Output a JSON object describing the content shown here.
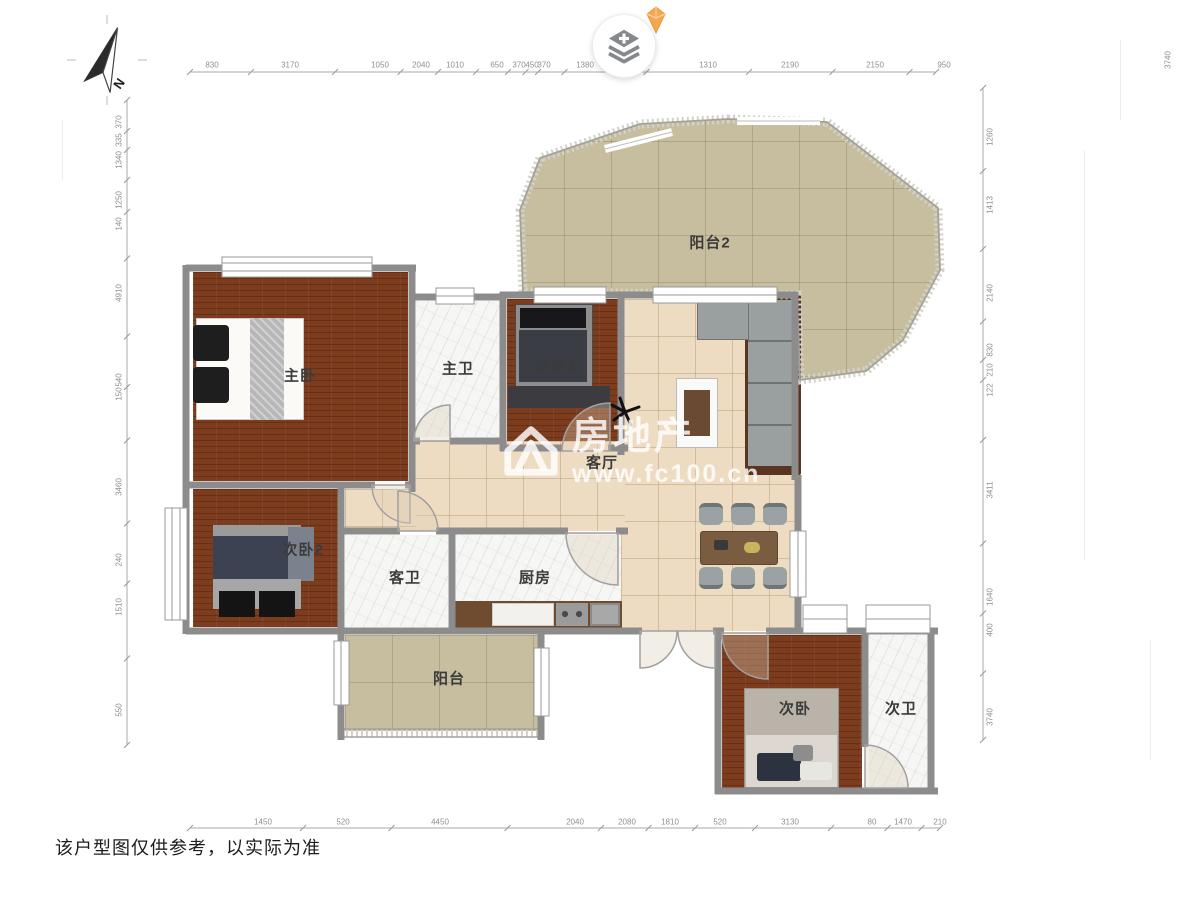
{
  "canvas": {
    "disclaimer": "该户型图仅供参考，以实际为准"
  },
  "compass": {
    "label": "N"
  },
  "toolbar": {
    "button_icon": "layers-add-icon",
    "badge_icon": "vip-gem-icon"
  },
  "watermark": {
    "brand": "房地产",
    "url": "www.fc100.cn",
    "logo_icon": "house-logo-icon"
  },
  "colors": {
    "wood": "#7d3c1e",
    "tile": "#eedcc2",
    "balcony": "#c7be9f",
    "marble": "#f6f6f4",
    "wall": "#8c8c8c",
    "gem": "#f3a74f"
  },
  "rooms": [
    {
      "id": "balcony2",
      "label": "阳台2",
      "x": 710,
      "y": 242
    },
    {
      "id": "master-bedroom",
      "label": "主卧",
      "x": 300,
      "y": 375
    },
    {
      "id": "master-bath",
      "label": "主卫",
      "x": 458,
      "y": 368
    },
    {
      "id": "bedroom3",
      "label": "次卧3",
      "x": 556,
      "y": 366
    },
    {
      "id": "living-room",
      "label": "客厅",
      "x": 602,
      "y": 462
    },
    {
      "id": "bedroom2",
      "label": "次卧2",
      "x": 303,
      "y": 549
    },
    {
      "id": "guest-bath",
      "label": "客卫",
      "x": 405,
      "y": 577
    },
    {
      "id": "kitchen",
      "label": "厨房",
      "x": 535,
      "y": 577
    },
    {
      "id": "balcony",
      "label": "阳台",
      "x": 449,
      "y": 678
    },
    {
      "id": "bedroom",
      "label": "次卧",
      "x": 795,
      "y": 708
    },
    {
      "id": "bath2",
      "label": "次卫",
      "x": 901,
      "y": 708
    }
  ],
  "rulers": {
    "top": {
      "vertical": false,
      "line": 72,
      "axis": 65,
      "start": 190,
      "end": 936,
      "labels": [
        {
          "v": "830",
          "pos": 212
        },
        {
          "v": "3170",
          "pos": 290
        },
        {
          "v": "1050",
          "pos": 380
        },
        {
          "v": "2040",
          "pos": 421
        },
        {
          "v": "1010",
          "pos": 455
        },
        {
          "v": "650",
          "pos": 497
        },
        {
          "v": "370",
          "pos": 519
        },
        {
          "v": "450",
          "pos": 532
        },
        {
          "v": "370",
          "pos": 544
        },
        {
          "v": "1380",
          "pos": 585
        },
        {
          "v": "1310",
          "pos": 708
        },
        {
          "v": "2190",
          "pos": 790
        },
        {
          "v": "2150",
          "pos": 875
        },
        {
          "v": "950",
          "pos": 944
        }
      ]
    },
    "bottom": {
      "vertical": false,
      "line": 828,
      "axis": 822,
      "start": 190,
      "end": 940,
      "labels": [
        {
          "v": "1450",
          "pos": 263
        },
        {
          "v": "520",
          "pos": 343
        },
        {
          "v": "4450",
          "pos": 440
        },
        {
          "v": "2040",
          "pos": 575
        },
        {
          "v": "2080",
          "pos": 627
        },
        {
          "v": "1810",
          "pos": 670
        },
        {
          "v": "520",
          "pos": 720
        },
        {
          "v": "3130",
          "pos": 790
        },
        {
          "v": "80",
          "pos": 872
        },
        {
          "v": "1470",
          "pos": 903
        },
        {
          "v": "210",
          "pos": 940
        }
      ]
    },
    "left": {
      "vertical": true,
      "line": 127,
      "axis": 119,
      "start": 100,
      "end": 745,
      "labels": [
        {
          "v": "370",
          "pos": 122
        },
        {
          "v": "335",
          "pos": 140
        },
        {
          "v": "1340",
          "pos": 160
        },
        {
          "v": "1250",
          "pos": 200
        },
        {
          "v": "140",
          "pos": 224
        },
        {
          "v": "4910",
          "pos": 293
        },
        {
          "v": "540",
          "pos": 380
        },
        {
          "v": "150",
          "pos": 394
        },
        {
          "v": "3460",
          "pos": 487
        },
        {
          "v": "240",
          "pos": 560
        },
        {
          "v": "1510",
          "pos": 607
        },
        {
          "v": "550",
          "pos": 710
        }
      ]
    },
    "right": {
      "vertical": true,
      "line": 983,
      "axis": 990,
      "start": 88,
      "end": 740,
      "labels": [
        {
          "v": "1260",
          "pos": 137
        },
        {
          "v": "1413",
          "pos": 205
        },
        {
          "v": "2140",
          "pos": 293
        },
        {
          "v": "830",
          "pos": 350
        },
        {
          "v": "210",
          "pos": 370
        },
        {
          "v": "122",
          "pos": 390
        },
        {
          "v": "3411",
          "pos": 490
        },
        {
          "v": "1640",
          "pos": 597
        },
        {
          "v": "400",
          "pos": 630
        },
        {
          "v": "3740",
          "pos": 717
        }
      ]
    },
    "edge": {
      "v": "3740"
    }
  }
}
